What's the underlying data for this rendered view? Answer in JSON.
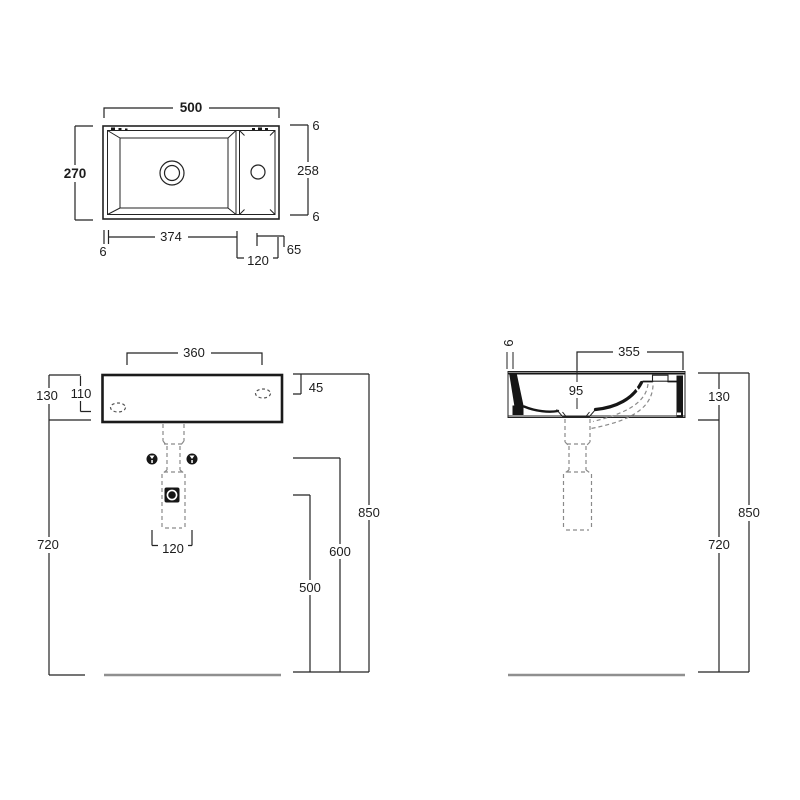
{
  "drawing_type": "washbasin technical dimension drawing",
  "colors": {
    "line": "#232323",
    "profile": "#161616",
    "dashed_hidden": "#8a8a8a",
    "floor_line": "#8f8f8f",
    "background": "#ffffff"
  },
  "views": {
    "plan": {
      "overall_width": "500",
      "overall_depth": "270",
      "rim_top": "6",
      "inner_depth": "258",
      "rim_bottom": "6",
      "rim_left": "6",
      "bowl_length": "374",
      "deck_width": "120",
      "tap_offset": "65"
    },
    "front": {
      "fixing_span": "360",
      "body_height": "130",
      "fixing_drop": "110",
      "apron_height": "45",
      "underside_height": "720",
      "waste_span": "120",
      "trap_height": "500",
      "bolt_height": "600",
      "rim_height": "850"
    },
    "side": {
      "rim_thickness": "6",
      "projection": "355",
      "bowl_depth": "95",
      "body_height": "130",
      "underside_height": "720",
      "rim_height": "850"
    }
  }
}
